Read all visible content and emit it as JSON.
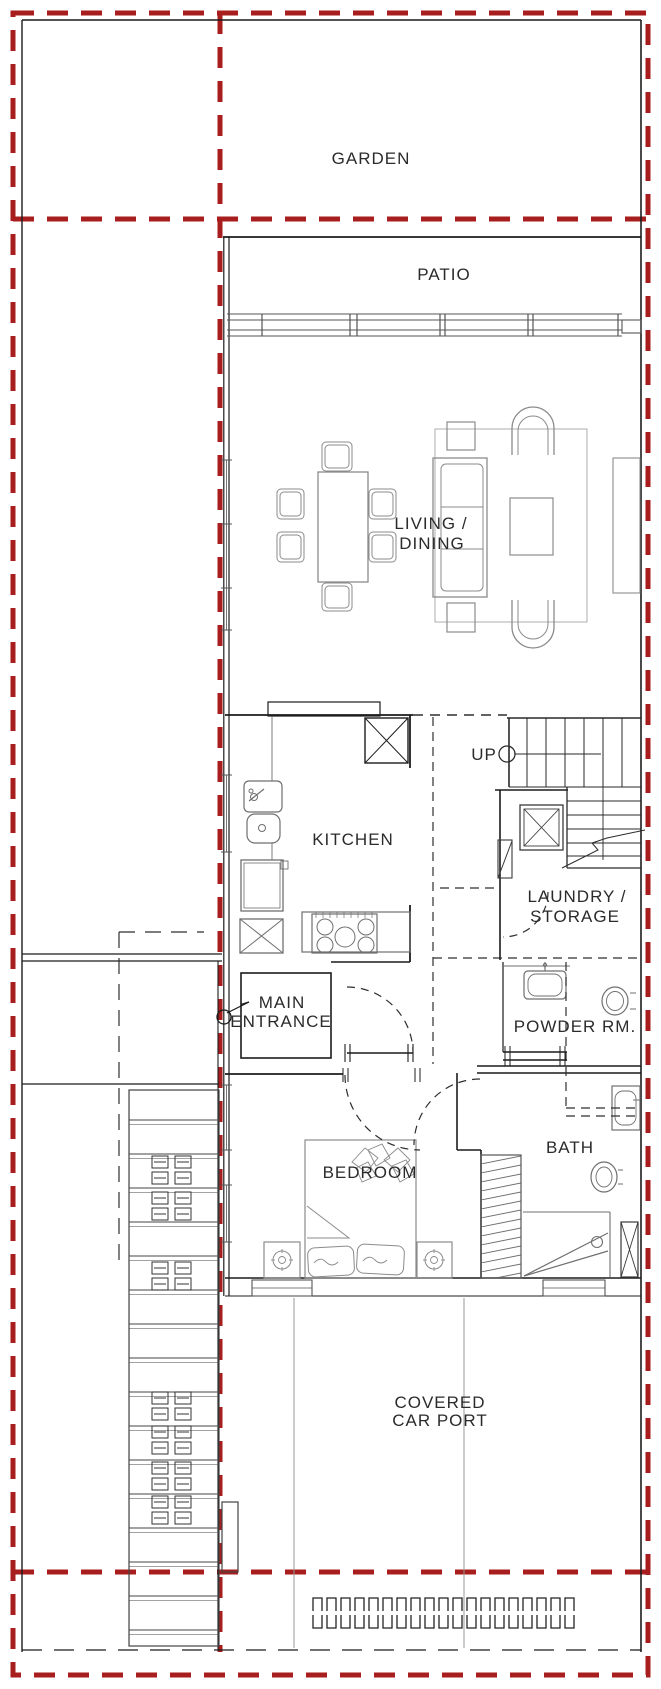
{
  "document": {
    "type": "architectural floor plan",
    "level": "ground floor"
  },
  "colors": {
    "property_line_red": "#a81e1e",
    "wall_black": "#1c1c1c",
    "furniture_gray": "#8b8b8b",
    "text": "#2b2b2b",
    "background": "#ffffff"
  },
  "labels": {
    "garden": "GARDEN",
    "patio": "PATIO",
    "living_dining_line1": "LIVING /",
    "living_dining_line2": "DINING",
    "kitchen": "KITCHEN",
    "up": "UP",
    "laundry_line1": "LAUNDRY /",
    "laundry_line2": "STORAGE",
    "main_entrance_line1": "MAIN",
    "main_entrance_line2": "ENTRANCE",
    "powder_room": "POWDER RM.",
    "bedroom": "BEDROOM",
    "bath": "BATH",
    "carport_line1": "COVERED",
    "carport_line2": "CAR PORT"
  }
}
